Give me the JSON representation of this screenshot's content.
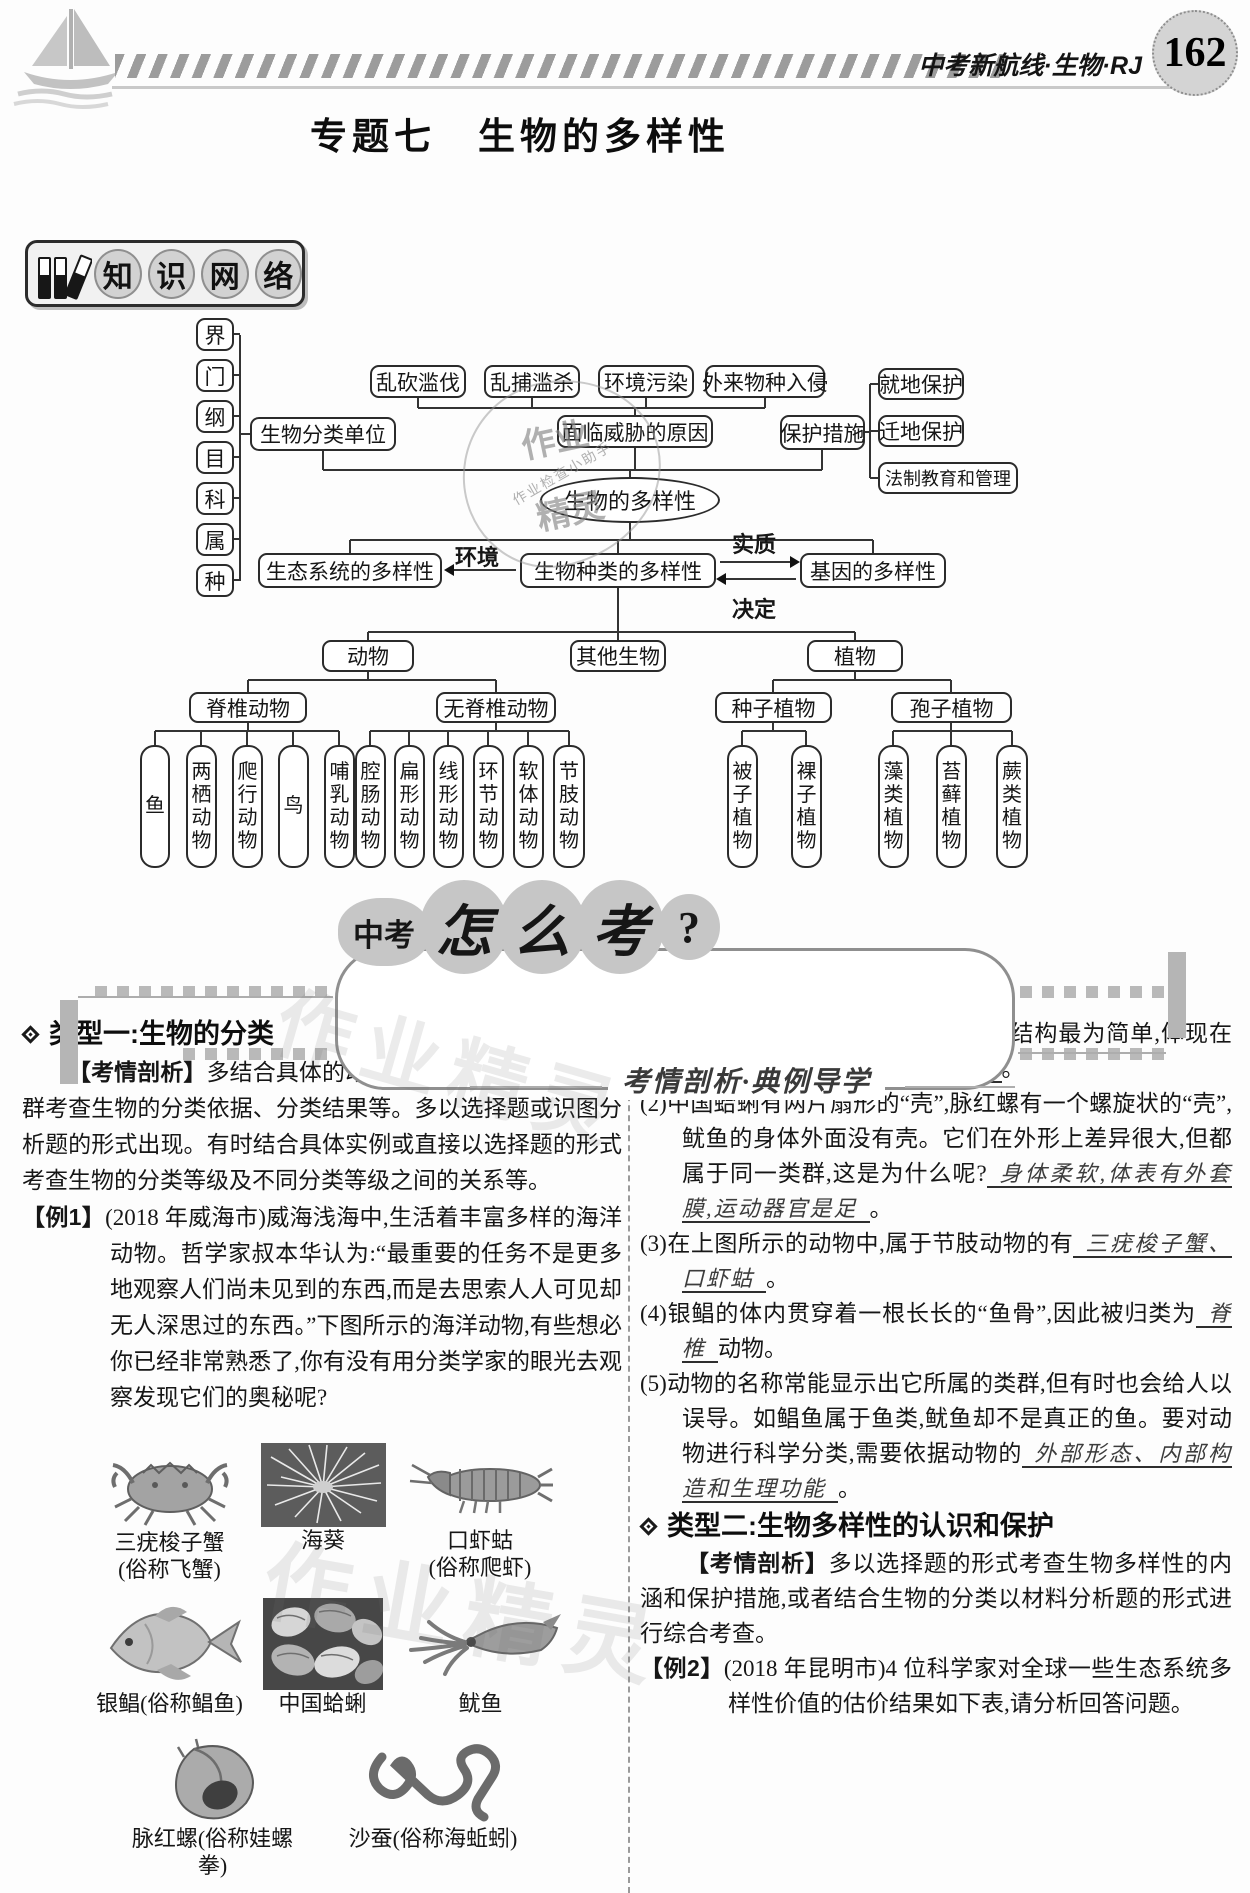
{
  "header": {
    "page_number": "162",
    "brand": "中考新航线·生物·RJ"
  },
  "title": "专题七　生物的多样性",
  "knowledge_badge": {
    "chars": [
      "知",
      "识",
      "网",
      "络"
    ]
  },
  "diagram": {
    "taxonomy_ranks": [
      "界",
      "门",
      "纲",
      "目",
      "科",
      "属",
      "种"
    ],
    "classification_unit": "生物分类单位",
    "threat_causes": [
      "乱砍滥伐",
      "乱捕滥杀",
      "环境污染",
      "外来物种入侵"
    ],
    "threat_title": "面临威胁的原因",
    "protection_title": "保护措施",
    "protection_methods": [
      "就地保护",
      "迁地保护",
      "法制教育和管理"
    ],
    "center": "生物的多样性",
    "ecosystem_diversity": "生态系统的多样性",
    "species_diversity": "生物种类的多样性",
    "gene_diversity": "基因的多样性",
    "edge_environment": "环境",
    "edge_essence": "实质",
    "edge_decide": "决定",
    "animal": "动物",
    "other": "其他生物",
    "plant": "植物",
    "vertebrate": "脊椎动物",
    "invertebrate": "无脊椎动物",
    "seed_plant": "种子植物",
    "spore_plant": "孢子植物",
    "vertebrate_groups": [
      "鱼",
      "两栖动物",
      "爬行动物",
      "鸟",
      "哺乳动物"
    ],
    "invertebrate_groups": [
      "腔肠动物",
      "扁形动物",
      "线形动物",
      "环节动物",
      "软体动物",
      "节肢动物"
    ],
    "seed_groups": [
      "被子植物",
      "裸子植物"
    ],
    "spore_groups": [
      "藻类植物",
      "苔藓植物",
      "蕨类植物"
    ]
  },
  "banner": {
    "prefix": "中考",
    "big_chars": [
      "怎",
      "么",
      "考"
    ],
    "question_mark": "?",
    "subtitle": "考情剖析·典例导学"
  },
  "left": {
    "heading": "类型一:生物的分类",
    "analysis_label": "【考情剖析】",
    "analysis_text": "多结合具体的动、植物名称或动、植物类群考查生物的分类依据、分类结果等。多以选择题或识图分析题的形式出现。有时结合具体实例或直接以选择题的形式考查生物的分类等级及不同分类等级之间的关系等。",
    "example_label": "【例1】",
    "example_text": "(2018 年威海市)威海浅海中,生活着丰富多样的海洋动物。哲学家叔本华认为:“最重要的任务不是更多地观察人们尚未见到的东西,而是去思索人人可见却无人深思过的东西。”下图所示的海洋动物,有些想必你已经非常熟悉了,你有没有用分类学家的眼光去观察发现它们的奥秘呢?",
    "photos": [
      {
        "name": "三疣梭子蟹",
        "alias": "(俗称飞蟹)"
      },
      {
        "name": "海葵",
        "alias": ""
      },
      {
        "name": "口虾蛄",
        "alias": "(俗称爬虾)"
      },
      {
        "name": "银鲳(俗称鲳鱼)",
        "alias": ""
      },
      {
        "name": "中国蛤蜊",
        "alias": ""
      },
      {
        "name": "鱿鱼",
        "alias": ""
      },
      {
        "name": "脉红螺(俗称娃螺拳)",
        "alias": ""
      },
      {
        "name": "沙蚕(俗称海蚯蚓)",
        "alias": ""
      }
    ]
  },
  "right": {
    "q1": {
      "text": "(1)在上图所示的动物中,海葵的形态结构最为简单,体现在",
      "answer": "身体呈辐射对称,有口无肛门",
      "suffix": "。"
    },
    "q2": {
      "text": "(2)中国蛤蜊有两片扇形的“壳”,脉红螺有一个螺旋状的“壳”,鱿鱼的身体外面没有壳。它们在外形上差异很大,但都属于同一类群,这是为什么呢?",
      "answer": "身体柔软,体表有外套膜,运动器官是足",
      "suffix": "。"
    },
    "q3": {
      "text": "(3)在上图所示的动物中,属于节肢动物的有",
      "answer": "三疣梭子蟹、口虾蛄",
      "suffix": "。"
    },
    "q4": {
      "text": "(4)银鲳的体内贯穿着一根长长的“鱼骨”,因此被归类为",
      "answer": "脊椎",
      "suffix": "动物。"
    },
    "q5": {
      "text": "(5)动物的名称常能显示出它所属的类群,但有时也会给人以误导。如鲳鱼属于鱼类,鱿鱼却不是真正的鱼。要对动物进行科学分类,需要依据动物的",
      "answer": "外部形态、内部构造和生理功能",
      "suffix": "。"
    },
    "heading": "类型二:生物多样性的认识和保护",
    "analysis_label": "【考情剖析】",
    "analysis_text": "多以选择题的形式考查生物多样性的内涵和保护措施,或者结合生物的分类以材料分析题的形式进行综合考查。",
    "example_label": "【例2】",
    "example_text": "(2018 年昆明市)4 位科学家对全球一些生态系统多样性价值的估价结果如下表,请分析回答问题。"
  },
  "watermark": {
    "stamp_top": "作业",
    "stamp_small": "作业检查小助手",
    "stamp_bottom": "精灵",
    "outline": "作业精灵"
  }
}
